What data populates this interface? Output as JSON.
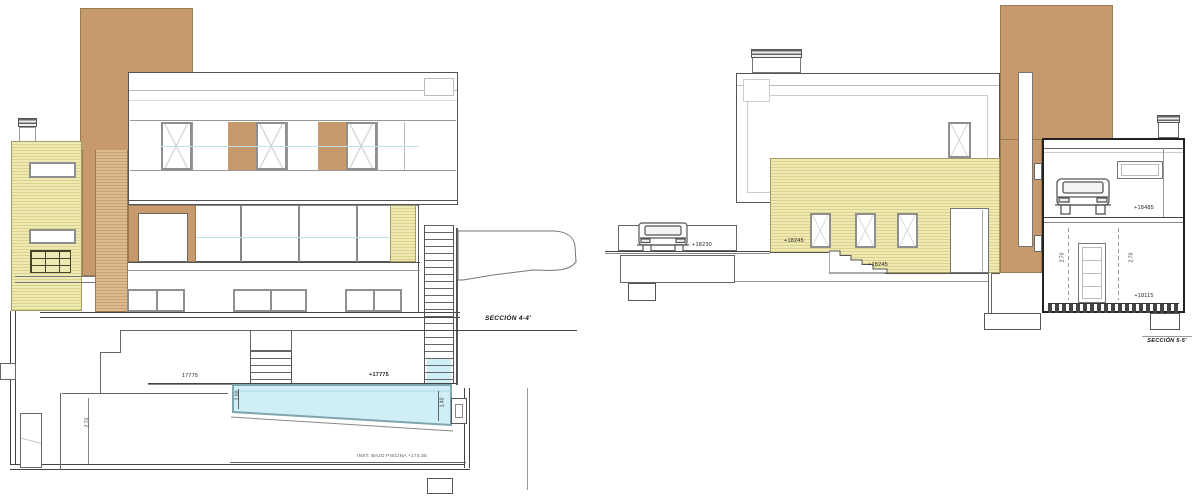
{
  "document": {
    "type": "architectural section drawing, two building sections"
  },
  "left_section": {
    "title": "SECCIÓN 4-4'",
    "levels": {
      "floor_dim": "17775",
      "pool_level": "+17775",
      "pool_note": "INST. BAJO PISCINA +174.35"
    },
    "dims": {
      "room_height": "2.70",
      "pool_depth_left": "1.00",
      "pool_depth_right": "1.40"
    }
  },
  "right_section": {
    "title": "SECCIÓN 5-5'",
    "levels": {
      "driveway": "+18230",
      "terrace": "+18245",
      "stairs": "+18245",
      "garage": "+18485",
      "entry": "+18115"
    },
    "dims": {
      "garage_height_left": "2.70",
      "garage_height_right": "2.70"
    }
  },
  "colors": {
    "facade_brown": "#c69a6d",
    "facade_yellow": "#ece7ae",
    "facade_tan": "#d7b288",
    "pool_blue": "#cfeef6",
    "line_dark": "#555555"
  }
}
